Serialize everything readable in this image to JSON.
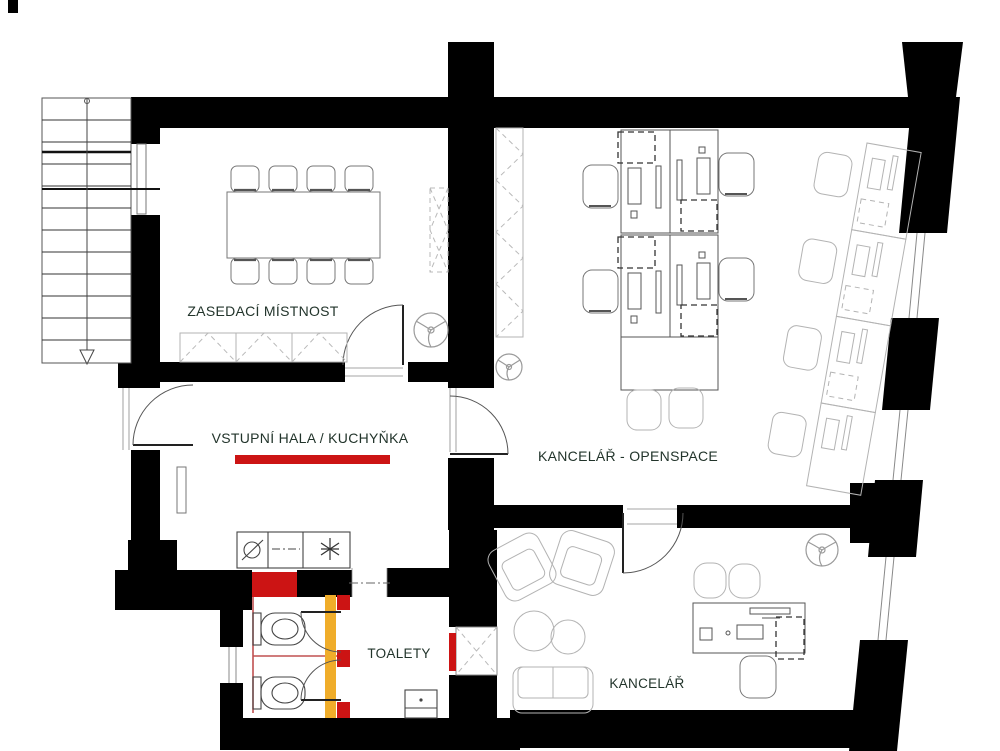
{
  "rooms": {
    "meeting": {
      "label": "ZASEDACÍ MÍSTNOST"
    },
    "hall": {
      "label": "VSTUPNÍ HALA / KUCHYŇKA"
    },
    "openspace": {
      "label": "KANCELÁŘ - OPENSPACE"
    },
    "toilets": {
      "label": "TOALETY"
    },
    "office": {
      "label": "KANCELÁŘ"
    }
  },
  "colors": {
    "wall": "#000000",
    "new_wall_red": "#cc1414",
    "thin_red": "#c05050",
    "partition_yellow": "#f0ad2a",
    "label_text": "#22342b",
    "furniture_gray": "#777777",
    "furniture_light": "#b3b3b3"
  },
  "icons": [
    "ceiling-fan-icon",
    "sink-icon",
    "hob-star-icon",
    "stairs-direction-arrow-icon",
    "toilet-icon",
    "washbasin-icon"
  ]
}
